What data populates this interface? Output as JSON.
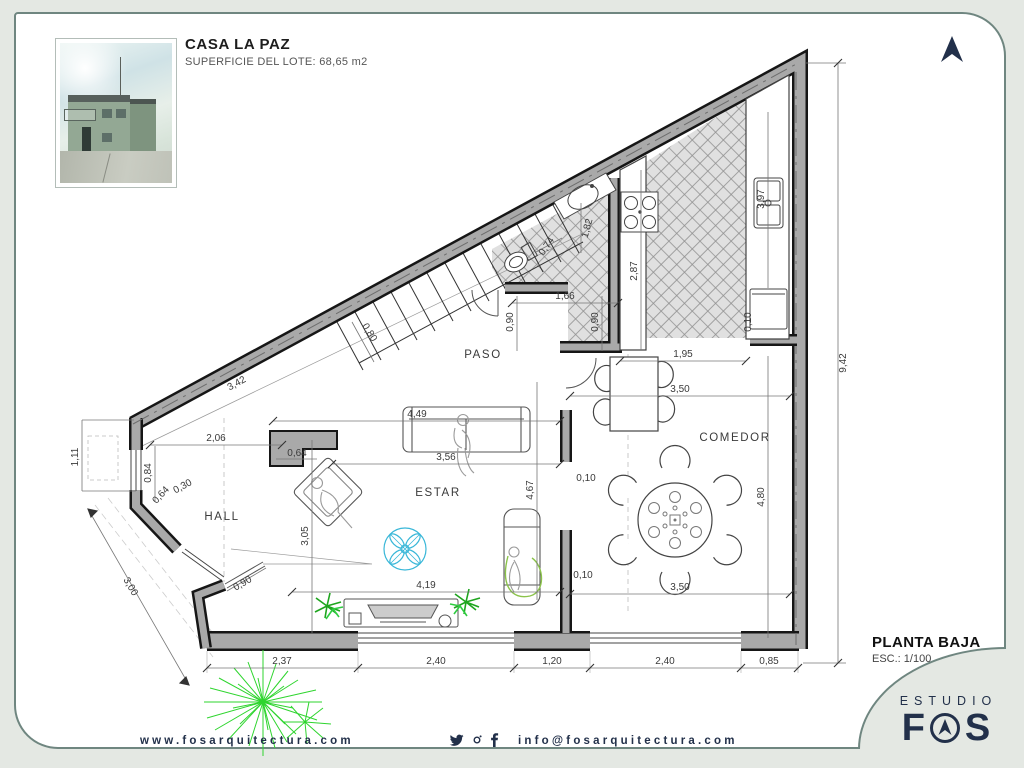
{
  "header": {
    "title": "CASA LA PAZ",
    "subtitle": "SUPERFICIE DEL LOTE: 68,65 m2"
  },
  "plan": {
    "rooms": {
      "paso": "PASO",
      "estar": "ESTAR",
      "hall": "HALL",
      "comedor": "COMEDOR"
    },
    "dims": {
      "d342": "3,42",
      "d080": "0,80",
      "d206": "2,06",
      "d111": "1,11",
      "d084": "0,84",
      "d064a": "0,64",
      "d030": "0,30",
      "d300": "3,00",
      "d090hall": "0,90",
      "d064b": "0,64",
      "d305": "3,05",
      "d237": "2,37",
      "d240a": "2,40",
      "d120": "1,20",
      "d240b": "2,40",
      "d085": "0,85",
      "d449": "4,49",
      "d356": "3,56",
      "d419": "4,19",
      "d467": "4,67",
      "d010a": "0,10",
      "d010b": "0,10",
      "d010c": "0,10",
      "d166": "1,66",
      "d090a": "0,90",
      "d090b": "0,90",
      "d074": "0,74",
      "d182": "1,82",
      "d287": "2,87",
      "d397": "3,97",
      "d195": "1,95",
      "d350a": "3,50",
      "d350b": "3,50",
      "d480": "4,80",
      "d942": "9,42"
    }
  },
  "titleblock": {
    "plan_name": "PLANTA BAJA",
    "scale": "ESC.: 1/100"
  },
  "footer": {
    "website": "www.fosarquitectura.com",
    "email": "info@fosarquitectura.com",
    "icons": [
      "twitter-icon",
      "instagram-icon",
      "facebook-icon"
    ]
  },
  "logo": {
    "studio": "ESTUDIO",
    "f": "F",
    "s": "S"
  },
  "colors": {
    "navy": "#22304a",
    "wall_fill": "#a9a9a9",
    "wall_edge": "#161616",
    "fan_accent": "#39b7d8",
    "tree_green": "#2ed52e",
    "palm_green": "#1ea51e",
    "background": "#e4e8e3",
    "card_border": "#6f8680"
  }
}
